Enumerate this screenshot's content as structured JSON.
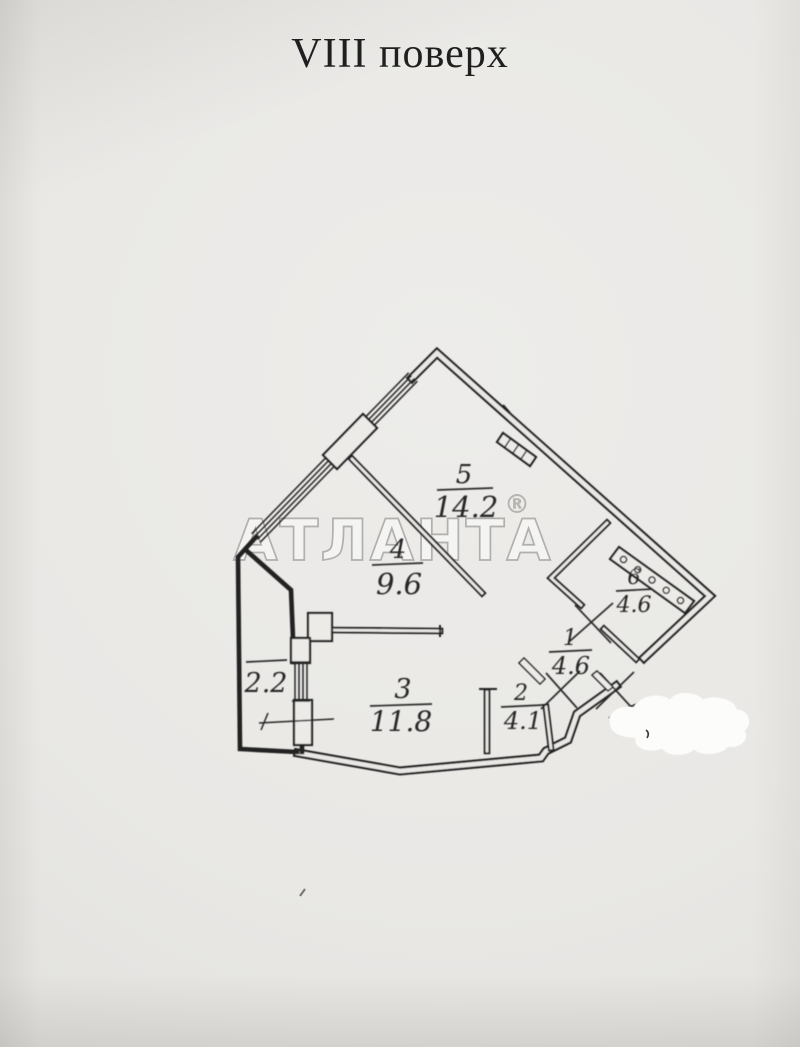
{
  "page": {
    "floor_title": "VIII поверх",
    "watermark": "АТЛАНТА",
    "registered_symbol": "®"
  },
  "plan": {
    "type": "apartment-floor-plan",
    "rooms": [
      {
        "number": "5",
        "area": "14.2"
      },
      {
        "number": "4",
        "area": "9.6"
      },
      {
        "number": "6",
        "area": "4.6"
      },
      {
        "number": "1",
        "area": "4.6"
      },
      {
        "number": "2",
        "area": "4.1"
      },
      {
        "number": "3",
        "area": "11.8"
      },
      {
        "number": "",
        "area": "2.2",
        "kind": "balcony"
      }
    ],
    "colors": {
      "paper": "#e9e8e5",
      "line": "#212121",
      "watermark": "#b1b0ad",
      "whiteout": "#fcfcfb"
    }
  }
}
